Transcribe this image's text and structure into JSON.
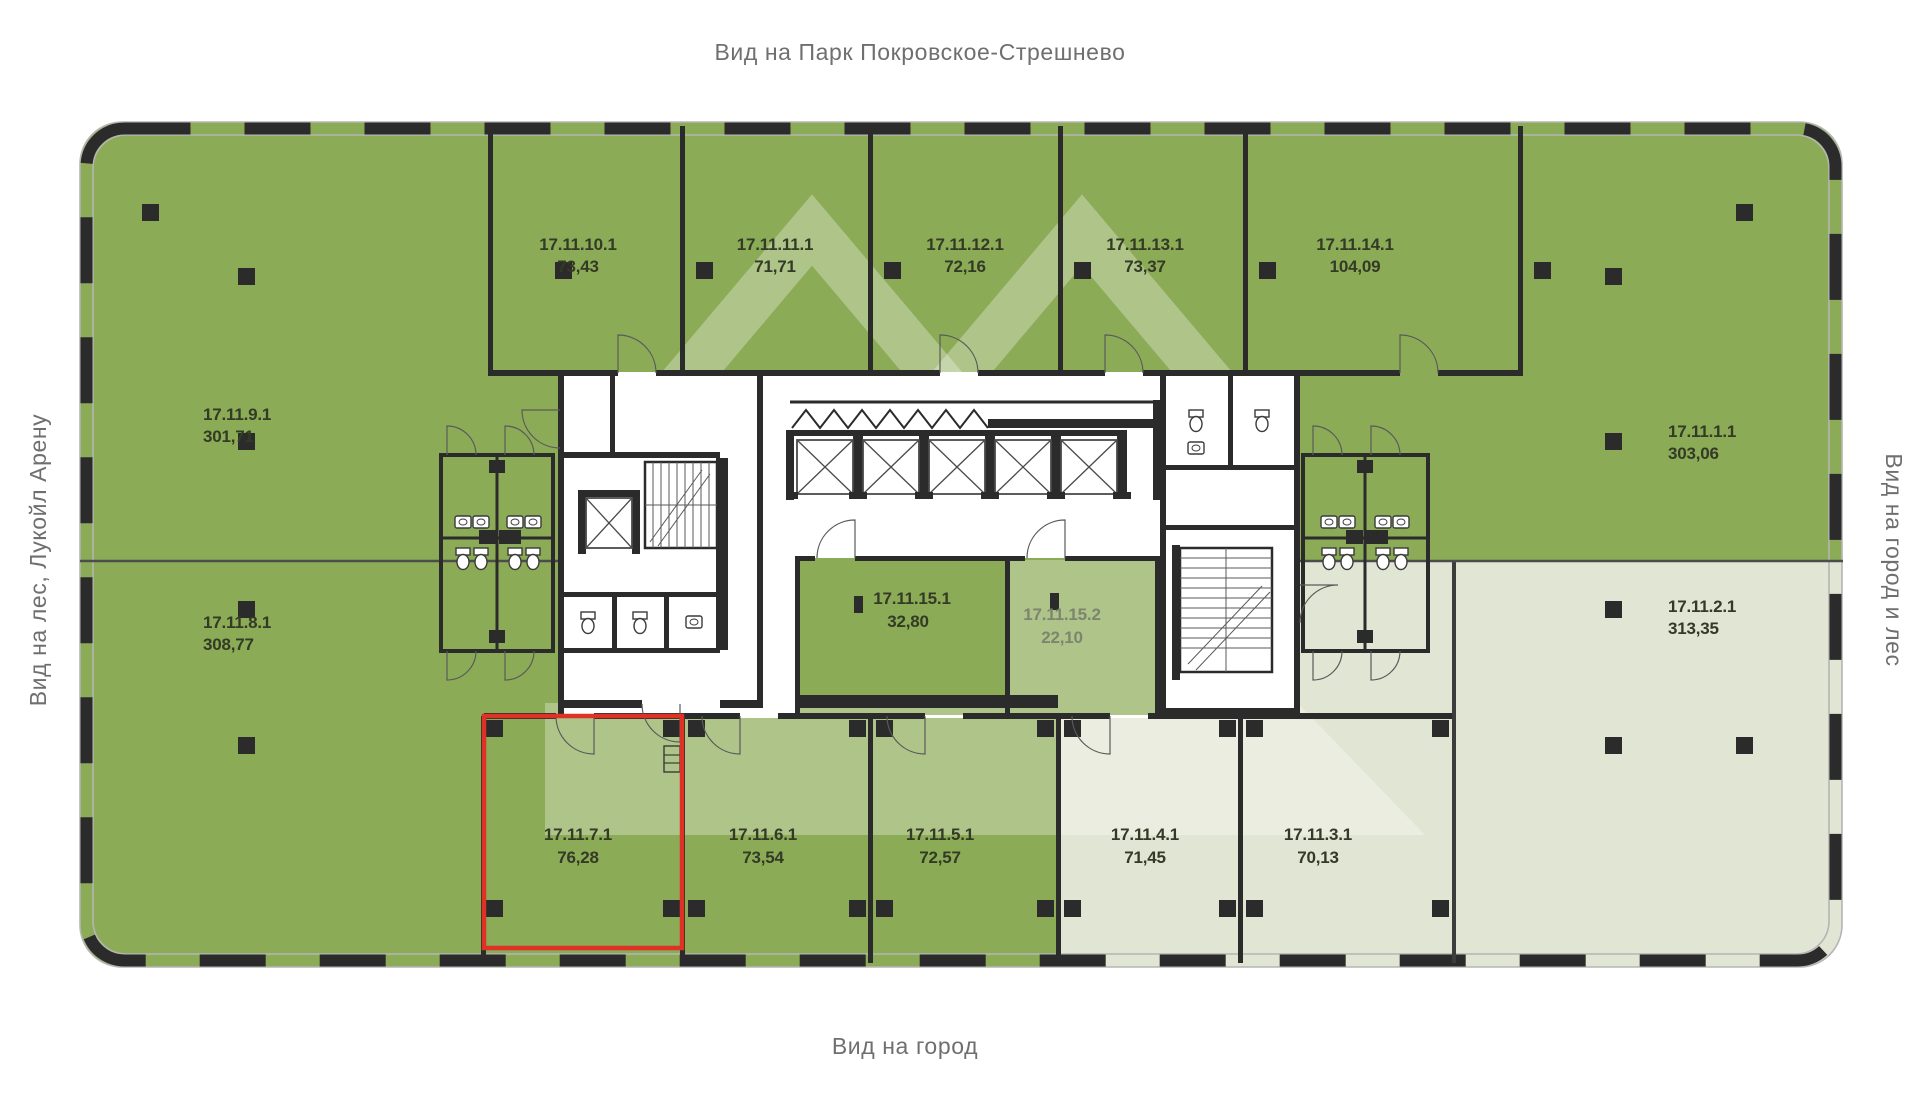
{
  "views": {
    "top": "Вид на Парк Покровское-Стрешнево",
    "bottom": "Вид на город",
    "left": "Вид на лес, Лукойл Арену",
    "right": "Вид на город и лес"
  },
  "selected_unit": "17.11.7.1",
  "colors": {
    "unit_green": "#8cab57",
    "unit_light": "#e1e5d3",
    "wall": "#2b2b2b",
    "highlight_red": "#de3227",
    "label_text": "#333a25",
    "view_text": "#6f6f6f"
  },
  "units": [
    {
      "id": "17.11.10.1",
      "area": "73,43"
    },
    {
      "id": "17.11.11.1",
      "area": "71,71"
    },
    {
      "id": "17.11.12.1",
      "area": "72,16"
    },
    {
      "id": "17.11.13.1",
      "area": "73,37"
    },
    {
      "id": "17.11.14.1",
      "area": "104,09"
    },
    {
      "id": "17.11.9.1",
      "area": "301,71"
    },
    {
      "id": "17.11.8.1",
      "area": "308,77"
    },
    {
      "id": "17.11.1.1",
      "area": "303,06"
    },
    {
      "id": "17.11.2.1",
      "area": "313,35"
    },
    {
      "id": "17.11.15.1",
      "area": "32,80"
    },
    {
      "id": "17.11.15.2",
      "area": "22,10"
    },
    {
      "id": "17.11.7.1",
      "area": "76,28"
    },
    {
      "id": "17.11.6.1",
      "area": "73,54"
    },
    {
      "id": "17.11.5.1",
      "area": "72,57"
    },
    {
      "id": "17.11.4.1",
      "area": "71,45"
    },
    {
      "id": "17.11.3.1",
      "area": "70,13"
    }
  ]
}
